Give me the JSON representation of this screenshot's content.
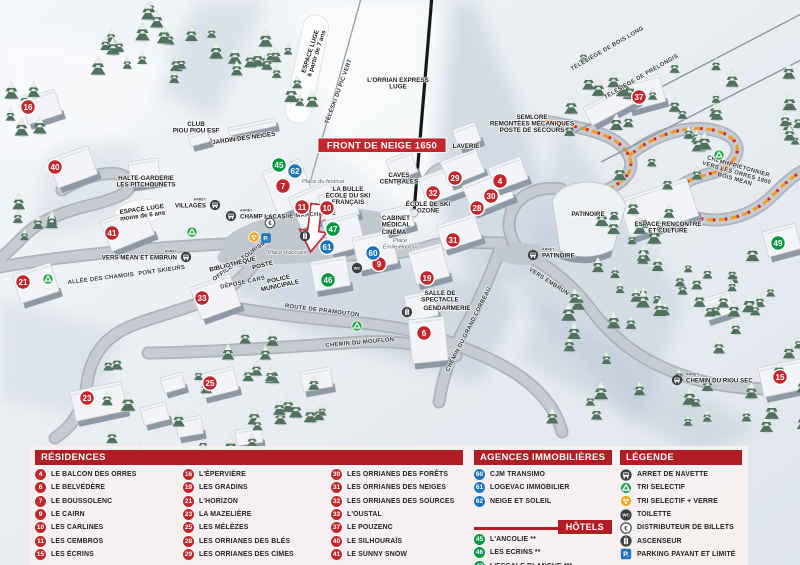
{
  "colors": {
    "header_red": "#b01e24",
    "banner_red": "#c1272d",
    "marker_red": "#c1272d",
    "marker_blue": "#1c75bc",
    "marker_green": "#00973f",
    "trail_orange": "#f49a23",
    "trail_red": "#d2232a",
    "tri_green": "#2aa84c",
    "tri_verre_orange": "#f5a623",
    "parking_blue": "#1c75bc"
  },
  "map": {
    "banner": "FRONT DE NEIGE 1650",
    "arret_label": "ARRÊT",
    "markers": [
      {
        "n": "16",
        "x": 28,
        "y": 107,
        "c": "red"
      },
      {
        "n": "40",
        "x": 55,
        "y": 167,
        "c": "red"
      },
      {
        "n": "41",
        "x": 112,
        "y": 233,
        "c": "red"
      },
      {
        "n": "21",
        "x": 23,
        "y": 282,
        "c": "red"
      },
      {
        "n": "33",
        "x": 202,
        "y": 298,
        "c": "red"
      },
      {
        "n": "23",
        "x": 87,
        "y": 398,
        "c": "red"
      },
      {
        "n": "25",
        "x": 210,
        "y": 383,
        "c": "red"
      },
      {
        "n": "7",
        "x": 283,
        "y": 186,
        "c": "red"
      },
      {
        "n": "11",
        "x": 302,
        "y": 207,
        "c": "red"
      },
      {
        "n": "10",
        "x": 327,
        "y": 208,
        "c": "red"
      },
      {
        "n": "9",
        "x": 379,
        "y": 264,
        "c": "red"
      },
      {
        "n": "19",
        "x": 427,
        "y": 278,
        "c": "red"
      },
      {
        "n": "6",
        "x": 424,
        "y": 333,
        "c": "red"
      },
      {
        "n": "29",
        "x": 455,
        "y": 178,
        "c": "red"
      },
      {
        "n": "4",
        "x": 500,
        "y": 181,
        "c": "red"
      },
      {
        "n": "32",
        "x": 433,
        "y": 193,
        "c": "red"
      },
      {
        "n": "30",
        "x": 491,
        "y": 196,
        "c": "red"
      },
      {
        "n": "28",
        "x": 477,
        "y": 208,
        "c": "red"
      },
      {
        "n": "31",
        "x": 453,
        "y": 240,
        "c": "red"
      },
      {
        "n": "37",
        "x": 639,
        "y": 97,
        "c": "red"
      },
      {
        "n": "15",
        "x": 780,
        "y": 377,
        "c": "red"
      },
      {
        "n": "45",
        "x": 279,
        "y": 165,
        "c": "green"
      },
      {
        "n": "47",
        "x": 333,
        "y": 229,
        "c": "green"
      },
      {
        "n": "46",
        "x": 328,
        "y": 280,
        "c": "green"
      },
      {
        "n": "49",
        "x": 778,
        "y": 243,
        "c": "green"
      },
      {
        "n": "62",
        "x": 295,
        "y": 171,
        "c": "blue"
      },
      {
        "n": "61",
        "x": 327,
        "y": 247,
        "c": "blue"
      },
      {
        "n": "60",
        "x": 373,
        "y": 253,
        "c": "blue"
      }
    ],
    "labels": [
      {
        "t": "CLUB|PIOU PIOU ESF",
        "x": 196,
        "y": 126,
        "k": "poi"
      },
      {
        "t": "JARDIN DES NEIGES",
        "x": 244,
        "y": 140,
        "r": -8,
        "k": "poi"
      },
      {
        "t": "HALTE-GARDERIE|LES PITCHOUNETS",
        "x": 146,
        "y": 180,
        "k": "poi"
      },
      {
        "t": "ESPACE LUGE|à partir de 7 ans",
        "x": 312,
        "y": 52,
        "r": -72,
        "k": "poi"
      },
      {
        "t": "ESPACE LUGE|moins de 6 ans",
        "x": 142,
        "y": 211,
        "r": -8,
        "k": "poi"
      },
      {
        "t": "L'ORRIAN EXPRESS|LUGE",
        "x": 398,
        "y": 82,
        "k": "poi"
      },
      {
        "t": "SEMLORE|REMONTÉES MÉCANIQUES|POSTE DE SECOURS",
        "x": 532,
        "y": 119,
        "k": "poi"
      },
      {
        "t": "LAVERIE",
        "x": 466,
        "y": 148,
        "k": "poi"
      },
      {
        "t": "CAVES|CENTRALES",
        "x": 399,
        "y": 177,
        "k": "poi"
      },
      {
        "t": "ÉCOLE DE SKI|OZONE",
        "x": 428,
        "y": 206,
        "k": "poi"
      },
      {
        "t": "CABINET|MÉDICAL",
        "x": 396,
        "y": 220,
        "k": "poi"
      },
      {
        "t": "CINÉMA",
        "x": 394,
        "y": 234,
        "k": "poi"
      },
      {
        "t": "Place|Émile Hodoul",
        "x": 400,
        "y": 242,
        "k": "place"
      },
      {
        "t": "Place du festival",
        "x": 323,
        "y": 183,
        "k": "place"
      },
      {
        "t": "LA BULLE|ÉCOLE DU SKI|FRANÇAIS",
        "x": 348,
        "y": 191,
        "k": "poi"
      },
      {
        "t": "GALERIE MARCHANDE",
        "x": 301,
        "y": 217,
        "r": -4,
        "k": "road"
      },
      {
        "t": "OFFICE DE TOURISME",
        "x": 242,
        "y": 261,
        "r": -36,
        "k": "road"
      },
      {
        "t": "BIBLIOTHÈQUE",
        "x": 233,
        "y": 266,
        "r": -14,
        "k": "poi"
      },
      {
        "t": "POSTE",
        "x": 263,
        "y": 267,
        "r": -14,
        "k": "poi"
      },
      {
        "t": "POLICE|MUNICIPALE",
        "x": 279,
        "y": 281,
        "r": -12,
        "k": "poi"
      },
      {
        "t": "DÉPOSE CARS",
        "x": 243,
        "y": 284,
        "r": -12,
        "k": "road"
      },
      {
        "t": "PONT SKIEURS",
        "x": 162,
        "y": 272,
        "r": -8,
        "k": "road"
      },
      {
        "t": "ALLÉE DES CHAMOIS",
        "x": 101,
        "y": 280,
        "r": -7,
        "k": "road"
      },
      {
        "t": "ROUTE DE PRAMOUTON",
        "x": 322,
        "y": 312,
        "r": 7,
        "k": "road"
      },
      {
        "t": "CHEMIN DU MOUFLON",
        "x": 360,
        "y": 344,
        "r": -5,
        "k": "road"
      },
      {
        "t": "CHEMIN DU GRAND CORBEAU",
        "x": 470,
        "y": 330,
        "r": -63,
        "k": "road"
      },
      {
        "t": "VERS EMBRUN",
        "x": 548,
        "y": 283,
        "r": 33,
        "k": "road"
      },
      {
        "t": "CHEMIN PIÉTONNIER|VERS LES ORRES 1800|BOIS MÉAN",
        "x": 738,
        "y": 168,
        "r": 16,
        "k": "road"
      },
      {
        "t": "PATINOIRE",
        "x": 588,
        "y": 216,
        "k": "poi"
      },
      {
        "t": "ESPACE RENCONTRE|ET CULTURE",
        "x": 668,
        "y": 226,
        "k": "poi"
      },
      {
        "t": "SALLE DE|SPECTACLE",
        "x": 440,
        "y": 295,
        "k": "poi"
      },
      {
        "t": "GENDARMERIE",
        "x": 447,
        "y": 310,
        "k": "poi"
      },
      {
        "t": "Place d'accueil",
        "x": 287,
        "y": 254,
        "k": "place"
      },
      {
        "t": "TÉLÉSKI DU PIC VERT",
        "x": 340,
        "y": 92,
        "r": -70,
        "k": "road"
      },
      {
        "t": "TÉLÉSIÈGE DE BOIS LONG",
        "x": 608,
        "y": 50,
        "r": -30,
        "k": "road"
      },
      {
        "t": "TÉLÉSIÈGE DE PRÉLONGIS",
        "x": 642,
        "y": 78,
        "r": -30,
        "k": "road"
      }
    ],
    "bus_stops": [
      {
        "label": "VILLAGES",
        "icon": [
          215,
          205
        ],
        "text": [
          206,
          205
        ],
        "anchor": "end"
      },
      {
        "label": "CHAMP LACAS",
        "icon": [
          231,
          216
        ],
        "text": [
          240,
          216
        ],
        "anchor": "start"
      },
      {
        "label": "VERS MÉAN ET EMBRUN",
        "icon": [
          186,
          257
        ],
        "text": [
          177,
          257
        ],
        "anchor": "end"
      },
      {
        "label": "PATINOIRE",
        "icon": [
          533,
          255
        ],
        "text": [
          542,
          255
        ],
        "anchor": "start"
      },
      {
        "label": "CHEMIN DU RIOU SEC",
        "icon": [
          677,
          380
        ],
        "text": [
          686,
          380
        ],
        "anchor": "start"
      }
    ],
    "icons": [
      {
        "t": "euro",
        "x": 270,
        "y": 223
      },
      {
        "t": "tri-verre",
        "x": 254,
        "y": 237
      },
      {
        "t": "parking",
        "x": 266,
        "y": 238
      },
      {
        "t": "ascenseur",
        "x": 305,
        "y": 236
      },
      {
        "t": "wc",
        "x": 357,
        "y": 268
      },
      {
        "t": "ascenseur",
        "x": 407,
        "y": 312
      },
      {
        "t": "tri",
        "x": 48,
        "y": 279
      },
      {
        "t": "tri",
        "x": 192,
        "y": 232
      },
      {
        "t": "tri",
        "x": 357,
        "y": 326
      },
      {
        "t": "tri",
        "x": 719,
        "y": 155
      }
    ]
  },
  "legend": {
    "residences": {
      "title": "RÉSIDENCES",
      "items": [
        {
          "n": "4",
          "label": "LE BALCON DES ORRES"
        },
        {
          "n": "6",
          "label": "LE BELVÉDÈRE"
        },
        {
          "n": "7",
          "label": "LE BOUSSOLENC"
        },
        {
          "n": "9",
          "label": "LE CAIRN"
        },
        {
          "n": "10",
          "label": "LES CARLINES"
        },
        {
          "n": "11",
          "label": "LES CEMBROS"
        },
        {
          "n": "15",
          "label": "LES ÉCRINS"
        },
        {
          "n": "16",
          "label": "L'ÉPERVIÈRE"
        },
        {
          "n": "19",
          "label": "LES GRADINS"
        },
        {
          "n": "21",
          "label": "L'HORIZON"
        },
        {
          "n": "23",
          "label": "LA MAZELIÈRE"
        },
        {
          "n": "25",
          "label": "LES MÉLÈZES"
        },
        {
          "n": "28",
          "label": "LES ORRIANES DES BLÉS"
        },
        {
          "n": "29",
          "label": "LES ORRIANES DES CIMES"
        },
        {
          "n": "30",
          "label": "LES ORRIANES DES FORÊTS"
        },
        {
          "n": "31",
          "label": "LES ORRIANES DES NEIGES"
        },
        {
          "n": "32",
          "label": "LES ORRIANES DES SOURCES"
        },
        {
          "n": "33",
          "label": "L'OUSTAL"
        },
        {
          "n": "37",
          "label": "LE POUZENC"
        },
        {
          "n": "40",
          "label": "LE SILHOURAÏS"
        },
        {
          "n": "41",
          "label": "LE SUNNY SNOW"
        }
      ]
    },
    "agences": {
      "title": "AGENCES IMMOBILIÈRES",
      "items": [
        {
          "n": "60",
          "label": "CJM TRANSIMO"
        },
        {
          "n": "61",
          "label": "LOGEVAC IMMOBILIER"
        },
        {
          "n": "62",
          "label": "NEIGE ET SOLEIL"
        }
      ]
    },
    "hotels": {
      "title": "HÔTELS",
      "items": [
        {
          "n": "45",
          "label": "L'ANCOLIE **"
        },
        {
          "n": "46",
          "label": "LES ECRINS **"
        },
        {
          "n": "47",
          "label": "L'ESCALE BLANCHE ***"
        },
        {
          "n": "49",
          "label": "LES TRAPPEURS **"
        }
      ]
    },
    "legende": {
      "title": "LÉGENDE",
      "items": [
        {
          "icon": "bus",
          "label": "ARRET DE NAVETTE"
        },
        {
          "icon": "tri",
          "label": "TRI SELECTIF"
        },
        {
          "icon": "tri-verre",
          "label": "TRI SELECTIF + VERRE"
        },
        {
          "icon": "wc",
          "label": "TOILETTE"
        },
        {
          "icon": "euro",
          "label": "DISTRIBUTEUR DE BILLETS"
        },
        {
          "icon": "ascenseur",
          "label": "ASCENSEUR"
        },
        {
          "icon": "parking",
          "label": "PARKING PAYANT ET LIMITÉ"
        }
      ]
    }
  }
}
